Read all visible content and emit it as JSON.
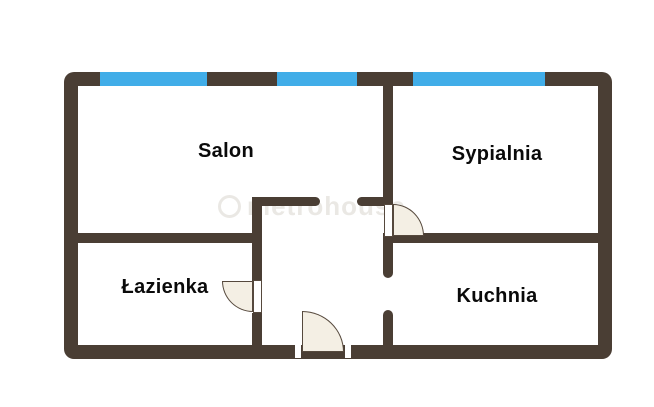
{
  "plan": {
    "type": "floor-plan",
    "colors": {
      "wall": "#4a3e34",
      "window": "#41ade8",
      "door_fill": "#f4efe4",
      "door_outline": "#56493d",
      "label": "#0a0a0a",
      "watermark": "#eae8e4",
      "bg": "#ffffff"
    },
    "rooms": [
      {
        "id": "salon",
        "label": "Salon"
      },
      {
        "id": "sypialnia",
        "label": "Sypialnia"
      },
      {
        "id": "lazienka",
        "label": "Łazienka"
      },
      {
        "id": "kuchnia",
        "label": "Kuchnia"
      }
    ],
    "watermark": {
      "text": "metrohouse"
    },
    "window_count": 3,
    "door_count": 3
  }
}
